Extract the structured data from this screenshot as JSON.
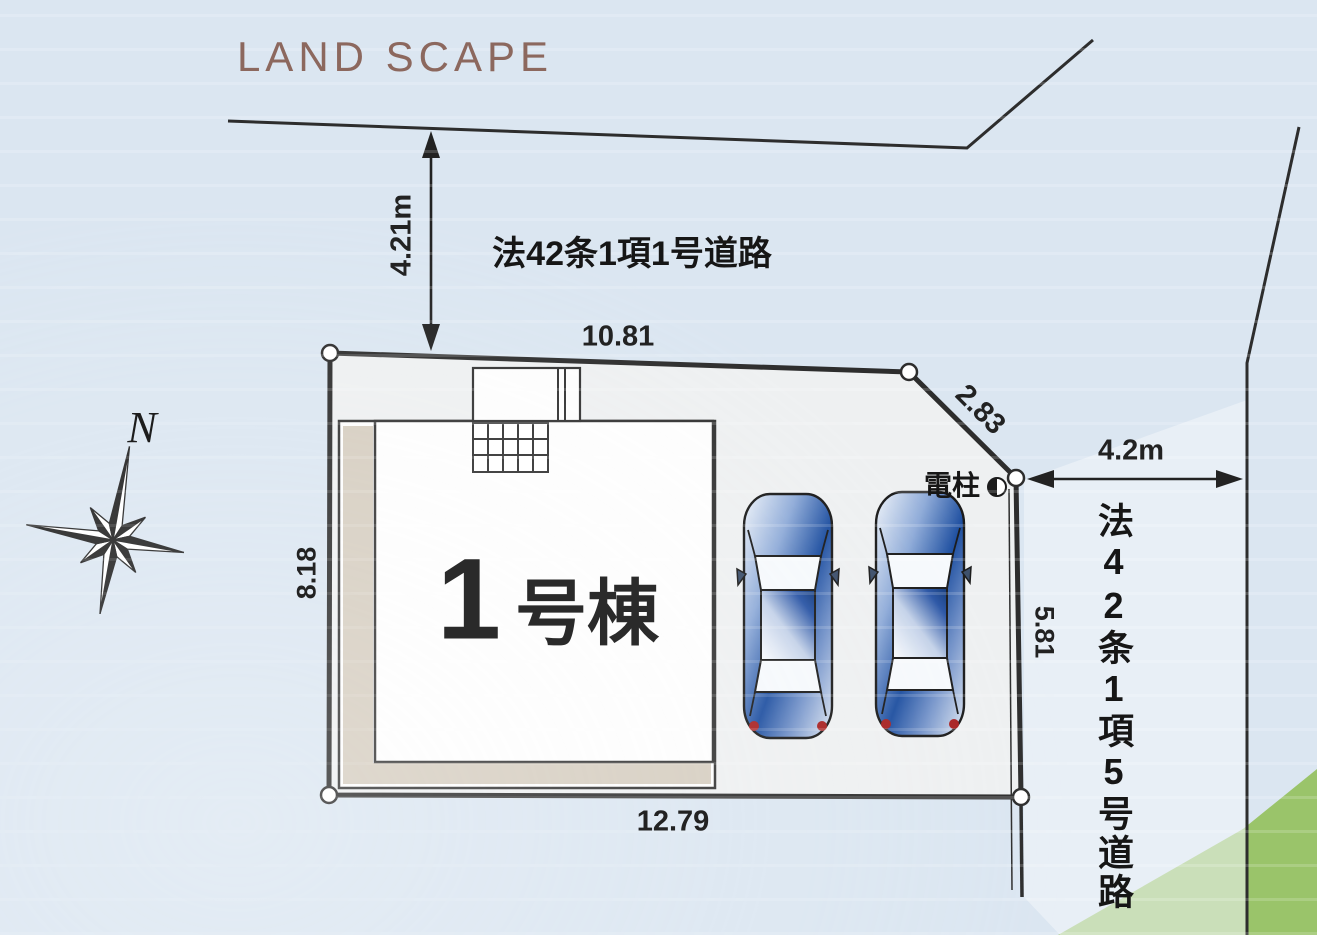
{
  "title": "LAND SCAPE",
  "compass": {
    "north": "N"
  },
  "roads": {
    "top_road": {
      "name": "法42条1項1号道路",
      "width": "4.21m"
    },
    "side_road": {
      "name": "法42条1項5号道路",
      "width": "4.2m"
    }
  },
  "plot": {
    "building": {
      "number": "1",
      "suffix": "号棟"
    },
    "utility_pole": "電柱",
    "dimensions": {
      "north": "10.81",
      "northeast": "2.83",
      "east": "5.81",
      "south": "12.79",
      "west": "8.18"
    }
  },
  "icons": {
    "utility_pole_symbol": "half-filled-circle",
    "compass_symbol": "eight-point-star"
  },
  "colors": {
    "background": "#dbe6f1",
    "title_text": "#8c685e",
    "line": "#2d2d2d",
    "plot_fill": "#eef0f1",
    "veranda_fill": "#d6cec1",
    "greenery": "#9ac46a",
    "car_blue": "#1e4fa0",
    "taillight_red": "#a82222"
  }
}
